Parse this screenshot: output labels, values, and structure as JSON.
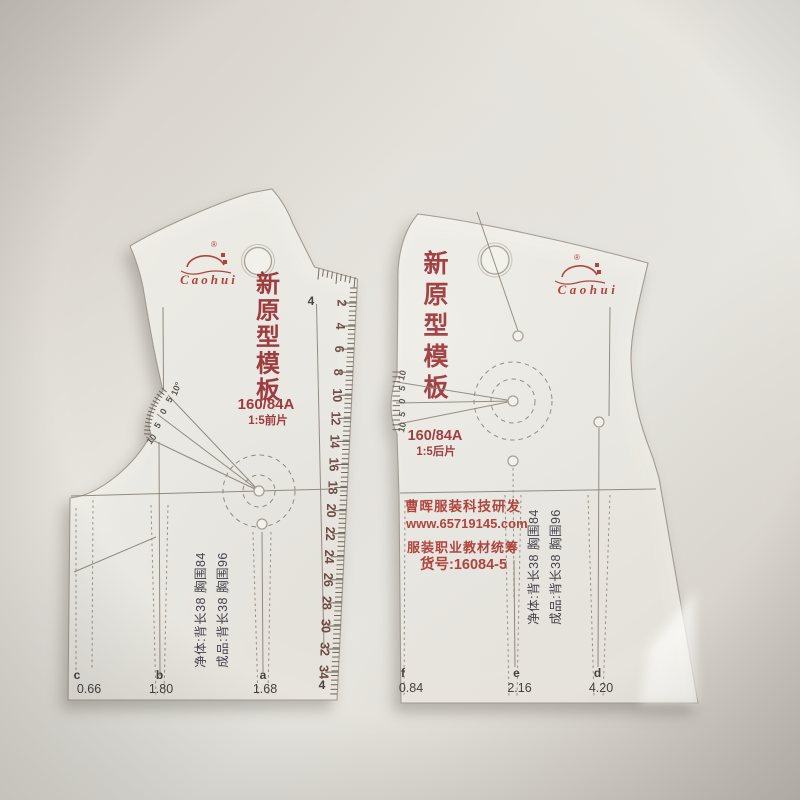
{
  "left_template": {
    "brand": "Caohui",
    "brand_mark": "®",
    "title": "新原型模板",
    "size": "160/84A",
    "scale_label": "1:5前片",
    "protractor_labels": [
      "10",
      "5",
      "0",
      "5",
      "10°"
    ],
    "ruler_numbers": [
      "2",
      "4",
      "6",
      "8",
      "10",
      "12",
      "14",
      "16",
      "18",
      "20",
      "22",
      "24",
      "26",
      "28",
      "30",
      "32",
      "34"
    ],
    "line_label_top": "4",
    "line_label_bottom": "4",
    "measure_line1": "净体:背长38  胸围84",
    "measure_line2": "成品:背长38  胸围96",
    "bottom_marks": [
      {
        "label": "c",
        "value": "0.66"
      },
      {
        "label": "b",
        "value": "1.80"
      },
      {
        "label": "a",
        "value": "1.68"
      }
    ]
  },
  "right_template": {
    "brand": "Caohui",
    "brand_mark": "®",
    "title": "新原型模板",
    "size": "160/84A",
    "scale_label": "1:5后片",
    "protractor_labels": [
      "10",
      "5",
      "0",
      "5",
      "10"
    ],
    "company": "曹晖服装科技研发",
    "website": "www.65719145.com",
    "series": "服装职业教材统筹",
    "item_no": "货号:16084-5",
    "measure_line1": "净体:背长38  胸围84",
    "measure_line2": "成品:背长38  胸围96",
    "bottom_marks": [
      {
        "label": "f",
        "value": "0.84"
      },
      {
        "label": "e",
        "value": "2.16"
      },
      {
        "label": "d",
        "value": "4.20"
      }
    ]
  },
  "colors": {
    "background": "#e5e2db",
    "plastic": "#f2f0ea",
    "print_red": "#9e3a3c",
    "pattern_line": "#8a8174",
    "dark_text": "#46424d",
    "ruler_number": "#6f4a44"
  }
}
